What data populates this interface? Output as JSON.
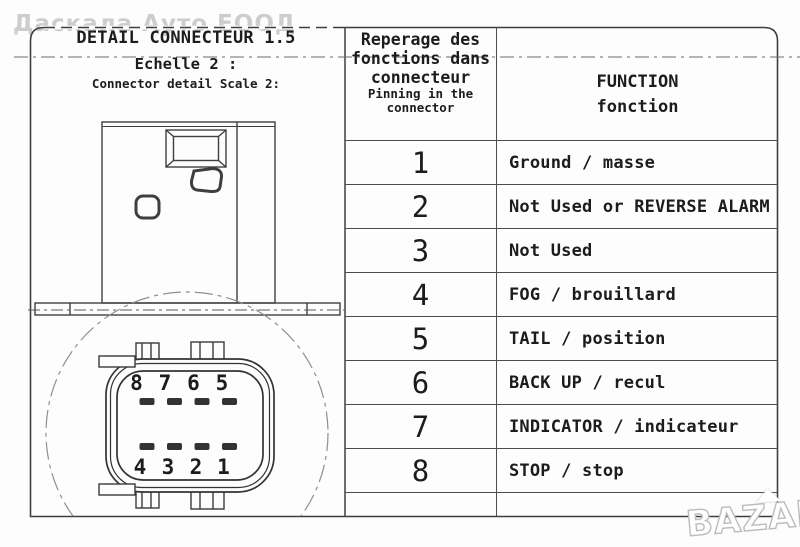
{
  "colors": {
    "ink": "#1c1c1c",
    "line": "#3f3f3f",
    "watermark_gray": "#cdcdcd"
  },
  "watermarks": {
    "top_text": "Даскала Ауто ЕООД",
    "bottom_logo": "BAZAR"
  },
  "detail_panel": {
    "title": "DETAIL CONNECTEUR 1.5",
    "scale_label_fr": "Echelle 2 :",
    "scale_label_en": "Connector detail Scale 2:",
    "pin_labels_top": [
      "8",
      "7",
      "6",
      "5"
    ],
    "pin_labels_bottom": [
      "4",
      "3",
      "2",
      "1"
    ]
  },
  "table": {
    "header": {
      "fr_lines": [
        "Reperage des",
        "fonctions dans",
        "connecteur"
      ],
      "en_lines": [
        "Pinning in the",
        "connector"
      ],
      "function_lines": [
        "FUNCTION",
        "fonction"
      ]
    },
    "rows": [
      {
        "pin": "1",
        "function": "Ground / masse"
      },
      {
        "pin": "2",
        "function": "Not Used or REVERSE ALARM"
      },
      {
        "pin": "3",
        "function": "Not Used"
      },
      {
        "pin": "4",
        "function": "FOG / brouillard"
      },
      {
        "pin": "5",
        "function": "TAIL / position"
      },
      {
        "pin": "6",
        "function": "BACK UP / recul"
      },
      {
        "pin": "7",
        "function": "INDICATOR / indicateur"
      },
      {
        "pin": "8",
        "function": "STOP / stop"
      }
    ]
  }
}
